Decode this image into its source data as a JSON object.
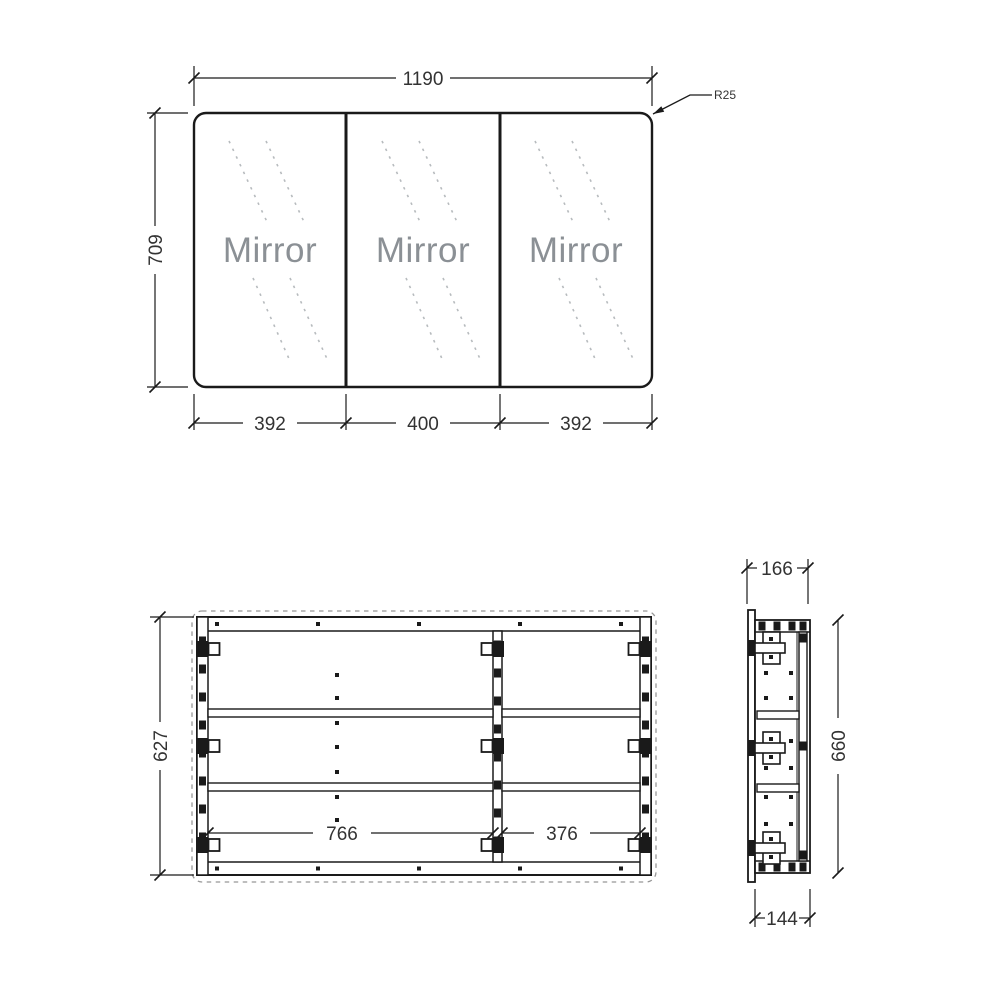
{
  "front_view": {
    "panel_label": "Mirror",
    "overall_width": "1190",
    "overall_height": "709",
    "door_widths": [
      "392",
      "400",
      "392"
    ],
    "corner_radius": "R25"
  },
  "carcass_view": {
    "internal_height": "627",
    "left_compartment_width": "766",
    "right_compartment_width": "376"
  },
  "side_view": {
    "overall_depth": "166",
    "carcass_height": "660",
    "carcass_depth": "144"
  },
  "colors": {
    "line": "#1a1a1a",
    "dim_text": "#333333",
    "mirror_text": "#8b9095",
    "hatch": "#b7bbbe",
    "dashed_outline": "#979797",
    "background": "#ffffff"
  }
}
